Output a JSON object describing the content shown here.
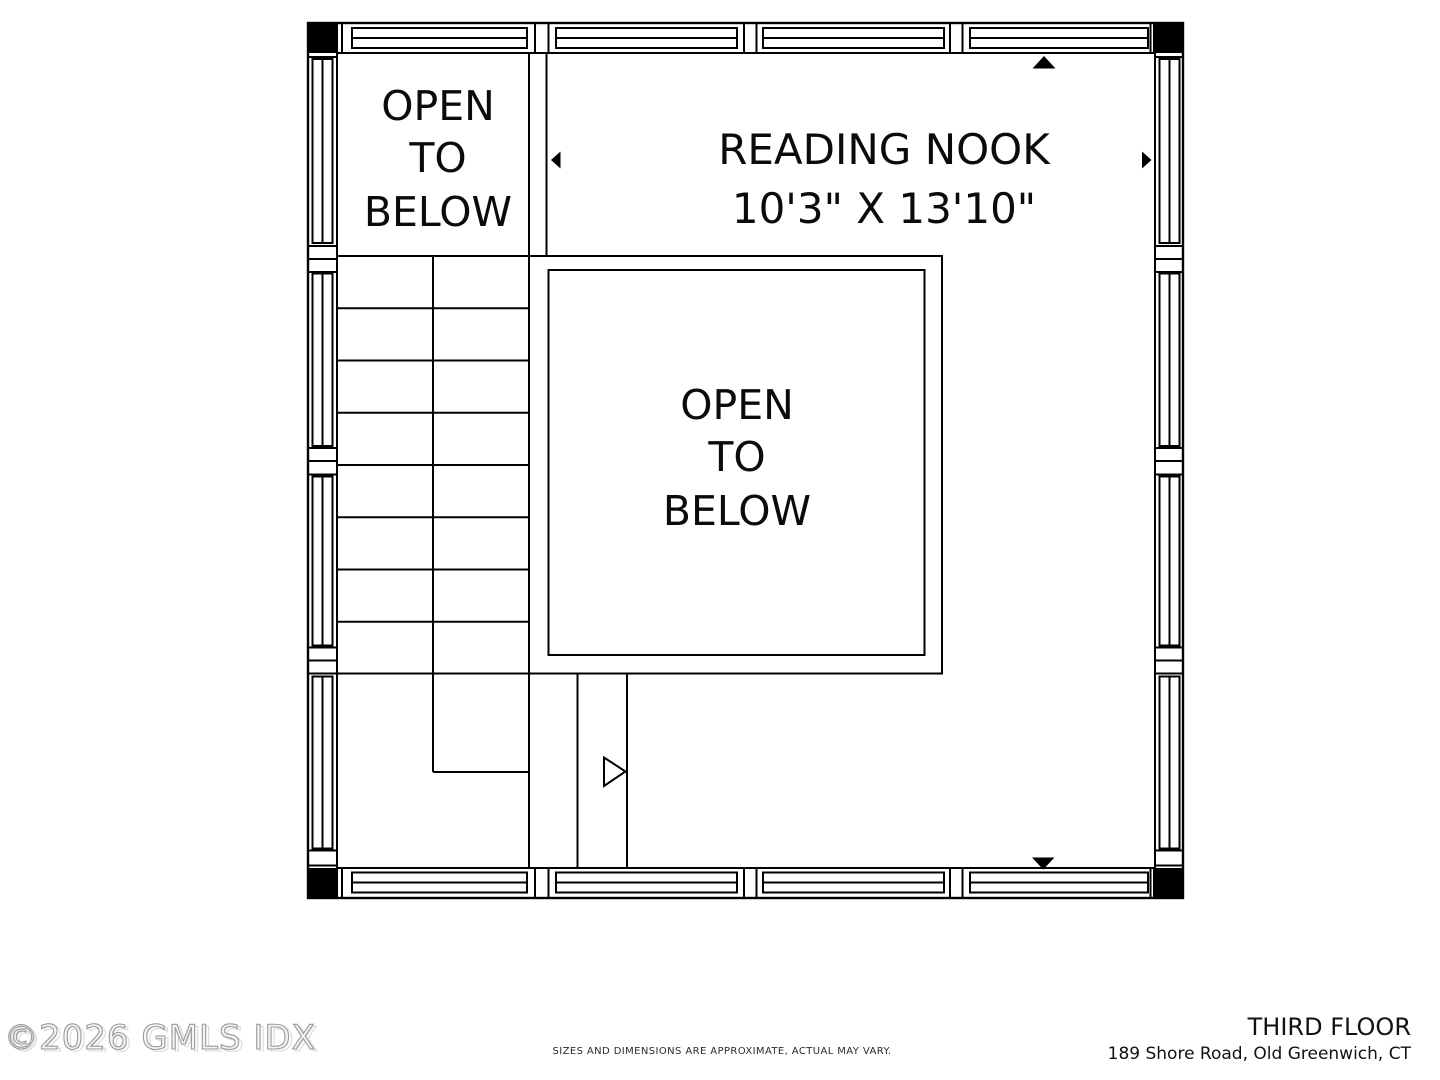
{
  "colors": {
    "background": "#ffffff",
    "wall": "#000000",
    "watermark": "#9a9a9a",
    "footer_text": "#121212"
  },
  "plan": {
    "room_open_below_top": {
      "line1": "OPEN",
      "line2": "TO",
      "line3": "BELOW"
    },
    "room_reading_nook": {
      "name": "READING NOOK",
      "dims": "10'3\" X 13'10\""
    },
    "room_open_below_center": {
      "line1": "OPEN",
      "line2": "TO",
      "line3": "BELOW"
    }
  },
  "icons": {
    "top_marker": "triangle-up-filled",
    "bottom_marker": "triangle-down-filled",
    "left_marker": "triangle-left-filled",
    "right_marker": "triangle-right-filled",
    "stair_direction": "triangle-right-outline"
  },
  "footer": {
    "floor_title": "THIRD FLOOR",
    "address": "189 Shore Road, Old Greenwich, CT",
    "disclaimer": "SIZES AND DIMENSIONS ARE APPROXIMATE, ACTUAL MAY VARY.",
    "watermark": "©2026 GMLS IDX"
  }
}
